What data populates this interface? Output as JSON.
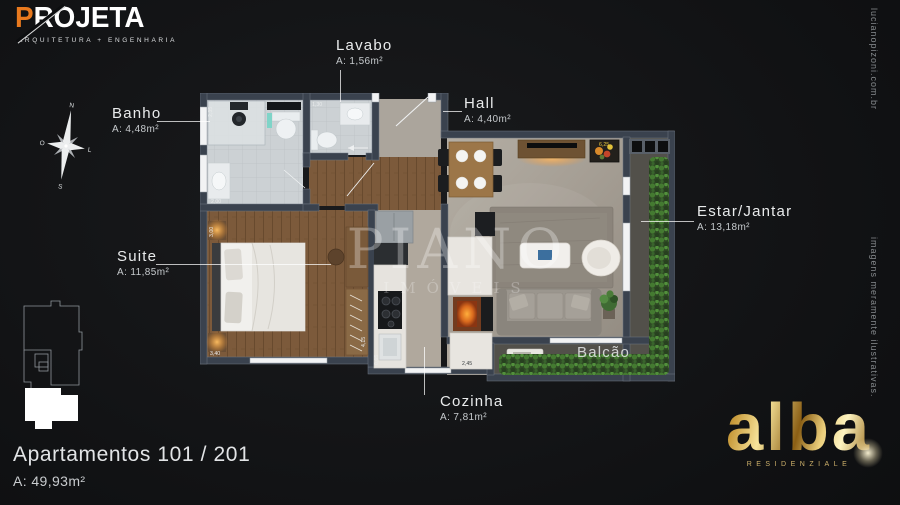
{
  "poster": {
    "projeta": {
      "initial": "P",
      "rest": "ROJETA",
      "tagline": "ARQUITETURA + ENGENHARIA"
    },
    "alba": {
      "name": "alba",
      "subtitle": "RESIDENZIALE"
    },
    "watermark": {
      "line1": "PIANO",
      "line2": "IMÓVEIS"
    },
    "side_top": "lucianopizoni.com.br",
    "side_bottom": "imagens meramente ilustrativas.",
    "title": "Apartamentos 101 / 201",
    "total_area": "A: 49,93m²"
  },
  "compass": {
    "north": "N",
    "south": "S",
    "east": "L",
    "west": "O"
  },
  "rooms": {
    "banho": {
      "name": "Banho",
      "area": "A: 4,48m²"
    },
    "lavabo": {
      "name": "Lavabo",
      "area": "A: 1,56m²"
    },
    "hall": {
      "name": "Hall",
      "area": "A: 4,40m²"
    },
    "estar": {
      "name": "Estar/Jantar",
      "area": "A: 13,18m²"
    },
    "suite": {
      "name": "Suite",
      "area": "A: 11,85m²"
    },
    "cozinha": {
      "name": "Cozinha",
      "area": "A: 7,81m²"
    },
    "balcao": {
      "name": "Balcão"
    }
  },
  "dims": {
    "banho_w": "2,35",
    "banho_d": "2,00",
    "lavabo_w": "1,30",
    "suite_w": "3,00",
    "suite_d": "3,40",
    "suite_l": "4,15",
    "counter_d": "0,65",
    "cozinha_w": "2,45",
    "estar_w": "6,25"
  },
  "colors": {
    "accent_orange": "#e8791e",
    "gold": "#d4af5a",
    "wall": "#3a424e"
  }
}
